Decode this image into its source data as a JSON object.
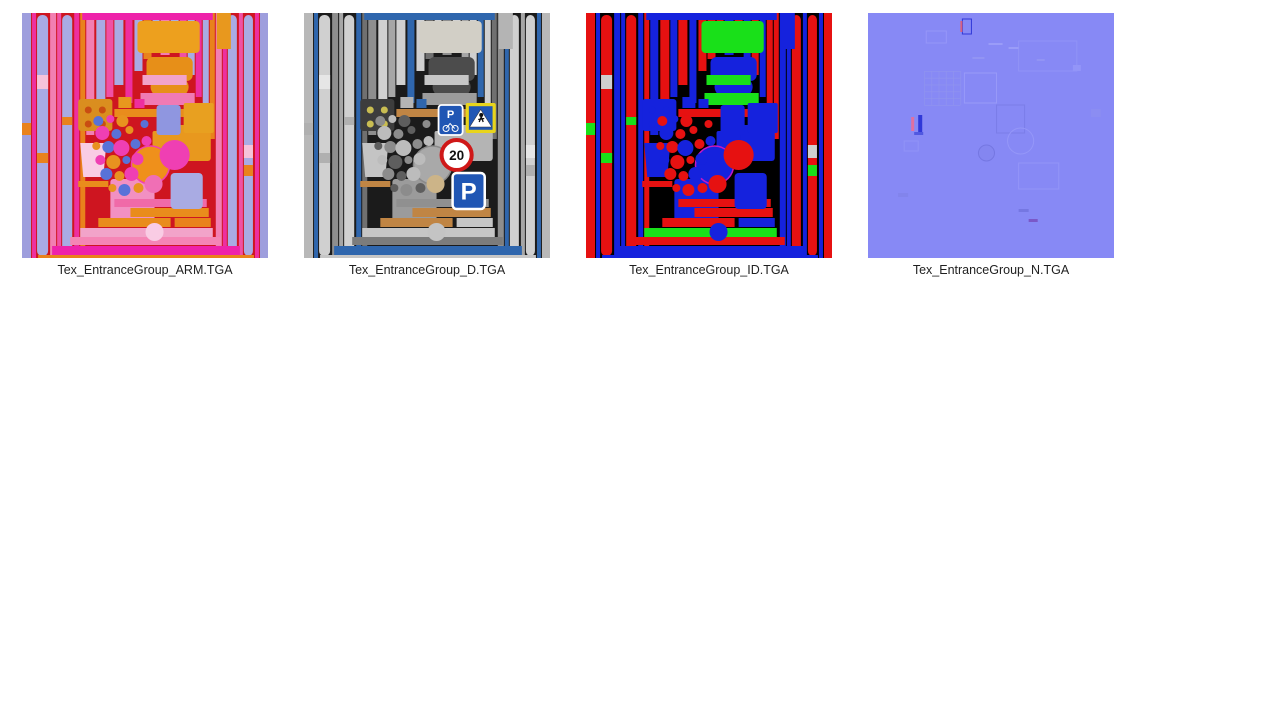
{
  "files": [
    {
      "label": "Tex_EntranceGroup_ARM.TGA",
      "map": "arm"
    },
    {
      "label": "Tex_EntranceGroup_D.TGA",
      "map": "d"
    },
    {
      "label": "Tex_EntranceGroup_ID.TGA",
      "map": "id"
    },
    {
      "label": "Tex_EntranceGroup_N.TGA",
      "map": "n"
    }
  ],
  "signs": {
    "parking_small": "P",
    "speed_limit": "20",
    "parking_large": "P"
  },
  "sign_colors": {
    "sign_blue": "#2056b4",
    "sign_yellow": "#e8d41c",
    "ring_red": "#cf1818",
    "sign_white": "#ffffff",
    "glyph_dark": "#111111"
  },
  "atlas": {
    "size": 245,
    "shapes": [
      [
        "r",
        0,
        0,
        9,
        245,
        "b1"
      ],
      [
        "r",
        10,
        0,
        4,
        245,
        "b2"
      ],
      [
        "r",
        15,
        2,
        11,
        241,
        "b3",
        5
      ],
      [
        "r",
        28,
        0,
        6,
        245,
        "b4"
      ],
      [
        "r",
        35,
        0,
        4,
        245,
        "b6"
      ],
      [
        "r",
        40,
        2,
        10,
        241,
        "b3",
        5
      ],
      [
        "r",
        52,
        0,
        5,
        245,
        "b2"
      ],
      [
        "r",
        58,
        0,
        5,
        245,
        "b5"
      ],
      [
        "r",
        64,
        0,
        8,
        122,
        "b4"
      ],
      [
        "r",
        74,
        0,
        9,
        100,
        "b3"
      ],
      [
        "r",
        84,
        0,
        7,
        84,
        "b6"
      ],
      [
        "r",
        92,
        0,
        9,
        72,
        "b3"
      ],
      [
        "r",
        103,
        0,
        7,
        90,
        "b2"
      ],
      [
        "r",
        112,
        0,
        8,
        58,
        "b3"
      ],
      [
        "r",
        121,
        0,
        8,
        46,
        "b5"
      ],
      [
        "r",
        130,
        0,
        7,
        40,
        "b3"
      ],
      [
        "r",
        138,
        0,
        9,
        42,
        "b4"
      ],
      [
        "r",
        148,
        0,
        8,
        38,
        "b3"
      ],
      [
        "r",
        157,
        0,
        7,
        52,
        "b6"
      ],
      [
        "r",
        165,
        0,
        7,
        62,
        "b3"
      ],
      [
        "r",
        173,
        0,
        6,
        84,
        "b2"
      ],
      [
        "r",
        180,
        0,
        6,
        104,
        "b3"
      ],
      [
        "r",
        187,
        0,
        5,
        126,
        "b5"
      ],
      [
        "r",
        193,
        0,
        6,
        245,
        "b4"
      ],
      [
        "r",
        200,
        0,
        4,
        245,
        "b2"
      ],
      [
        "r",
        205,
        2,
        9,
        241,
        "b3",
        5
      ],
      [
        "r",
        216,
        0,
        4,
        245,
        "b6"
      ],
      [
        "r",
        221,
        2,
        9,
        241,
        "b3",
        5
      ],
      [
        "r",
        232,
        0,
        4,
        245,
        "b2"
      ],
      [
        "r",
        237,
        0,
        8,
        245,
        "b1"
      ],
      [
        "r",
        15,
        62,
        11,
        14,
        "idw"
      ],
      [
        "r",
        15,
        140,
        11,
        10,
        "idg"
      ],
      [
        "r",
        40,
        104,
        10,
        8,
        "idg"
      ],
      [
        "r",
        221,
        132,
        9,
        13,
        "idw"
      ],
      [
        "r",
        221,
        152,
        9,
        11,
        "idg"
      ],
      [
        "r",
        0,
        110,
        9,
        12,
        "idg"
      ],
      [
        "r",
        194,
        0,
        14,
        36,
        "sq"
      ],
      [
        "r",
        60,
        0,
        130,
        7,
        "acc"
      ],
      [
        "r",
        115,
        8,
        62,
        32,
        "pane",
        4
      ],
      [
        "r",
        124,
        44,
        46,
        24,
        "pane2",
        6
      ],
      [
        "e",
        147,
        74,
        19,
        13,
        "pane2"
      ],
      [
        "r",
        120,
        62,
        44,
        10,
        "grn2"
      ],
      [
        "r",
        118,
        80,
        54,
        12,
        "grn"
      ],
      [
        "r",
        92,
        96,
        88,
        8,
        "met"
      ],
      [
        "r",
        56,
        86,
        34,
        32,
        "dark1",
        3
      ],
      [
        "c",
        66,
        97,
        3.5,
        "dot"
      ],
      [
        "c",
        80,
        97,
        3.5,
        "dot"
      ],
      [
        "c",
        66,
        111,
        3.5,
        "dot"
      ],
      [
        "c",
        80,
        111,
        3.5,
        "dot"
      ],
      [
        "r",
        96,
        84,
        13,
        11,
        "sq"
      ],
      [
        "r",
        112,
        86,
        10,
        9,
        "b2"
      ],
      [
        "p",
        "M58,130h26l-3,34h-20z",
        "box1"
      ],
      [
        "r",
        56,
        168,
        30,
        6,
        "met"
      ],
      [
        "r",
        88,
        166,
        44,
        48,
        "box2",
        3
      ],
      [
        "r",
        150,
        112,
        38,
        36,
        "sq",
        3
      ],
      [
        "r",
        130,
        118,
        24,
        24,
        "sq",
        2
      ],
      [
        "cs",
        128,
        152,
        19,
        "bigc",
        "bigcs",
        1.5
      ],
      [
        "c",
        76,
        108,
        5,
        "circA"
      ],
      [
        "c",
        88,
        106,
        4,
        "circB"
      ],
      [
        "c",
        100,
        108,
        6,
        "circC"
      ],
      [
        "c",
        80,
        120,
        7,
        "circB"
      ],
      [
        "c",
        94,
        121,
        5,
        "circA"
      ],
      [
        "c",
        107,
        117,
        4,
        "circC"
      ],
      [
        "c",
        74,
        133,
        4,
        "circC"
      ],
      [
        "c",
        86,
        134,
        6,
        "circA"
      ],
      [
        "c",
        99,
        135,
        8,
        "circB"
      ],
      [
        "c",
        113,
        131,
        5,
        "circA"
      ],
      [
        "c",
        78,
        147,
        5,
        "circB"
      ],
      [
        "c",
        91,
        149,
        7,
        "circC"
      ],
      [
        "c",
        104,
        147,
        4,
        "circA"
      ],
      [
        "c",
        115,
        146,
        6,
        "circB"
      ],
      [
        "c",
        84,
        161,
        6,
        "circA"
      ],
      [
        "c",
        97,
        163,
        5,
        "circC"
      ],
      [
        "c",
        109,
        161,
        7,
        "circB"
      ],
      [
        "c",
        90,
        175,
        4,
        "circC"
      ],
      [
        "c",
        102,
        177,
        6,
        "circA"
      ],
      [
        "c",
        116,
        175,
        5,
        "circC"
      ],
      [
        "c",
        124,
        128,
        5,
        "circB"
      ],
      [
        "c",
        122,
        111,
        4,
        "circA"
      ],
      [
        "c",
        131,
        171,
        9,
        "bigc2"
      ],
      [
        "r",
        92,
        186,
        92,
        8,
        "hb1"
      ],
      [
        "r",
        108,
        195,
        78,
        9,
        "met"
      ],
      [
        "r",
        76,
        205,
        72,
        9,
        "met"
      ],
      [
        "r",
        152,
        205,
        36,
        9,
        "hb2"
      ],
      [
        "r",
        58,
        215,
        132,
        9,
        "grn2"
      ],
      [
        "r",
        48,
        224,
        150,
        8,
        "hb3"
      ],
      [
        "c",
        132,
        219,
        9,
        "box1"
      ],
      [
        "r",
        30,
        233,
        187,
        9,
        "acc"
      ],
      [
        "r",
        16,
        242,
        215,
        3,
        "hb2"
      ],
      [
        "sign-pbike",
        134,
        92,
        24,
        30
      ],
      [
        "sign-cross",
        161,
        90,
        30,
        30
      ],
      [
        "sign-20",
        152,
        142,
        15
      ],
      [
        "sign-pbig",
        148,
        160,
        32,
        36
      ]
    ],
    "palettes": {
      "arm": {
        "bg": "#ce1520",
        "b1": "#9e9edd",
        "b2": "#ee2f9f",
        "b3": "#a9abe3",
        "b4": "#f27fb2",
        "b5": "#e9821c",
        "b6": "#f051a4",
        "idg": "#e9821c",
        "idw": "#f6c3da",
        "met": "#e98c1c",
        "pane": "#eda01e",
        "pane2": "#e78f18",
        "grn": "#f07ab4",
        "grn2": "#f2a3c9",
        "dark1": "#da8e1f",
        "dot": "#c94d12",
        "sq": "#e8981e",
        "box1": "#f9cce4",
        "box2": "#f290c2",
        "bigc": "#ef901b",
        "bigcs": "#f23fb0",
        "bigc2": "#f06fb5",
        "circA": "#5872d8",
        "circB": "#ef3fb3",
        "circC": "#e8921f",
        "hb1": "#f06aa8",
        "hb2": "#e9821c",
        "hb3": "#f585b5",
        "acc": "#ee22aa",
        "sgn1": "#8f96e0",
        "sgn2": "#e8a020",
        "s20f": "#ef3fb3",
        "sgnP": "#a9abe3"
      },
      "d": {
        "bg": "#1b1b1b",
        "b1": "#b8b8b8",
        "b2": "#2f66ad",
        "b3": "#d0d0d0",
        "b4": "#8e8e8e",
        "b5": "#707070",
        "b6": "#a6a6a6",
        "idg": "#b0b0b0",
        "idw": "#e6e6e6",
        "met": "#c08544",
        "pane": "#d2cfc6",
        "pane2": "#4c4c4c",
        "grn": "#9c9c9c",
        "grn2": "#c6c6c6",
        "dark1": "#3d3d3d",
        "dot": "#c9bd52",
        "sq": "#b4b4b4",
        "box1": "#c4c4c4",
        "box2": "#9b9b9b",
        "bigc": "#a9a9a9",
        "bigcs": "#8a8a8a",
        "bigc2": "#ccb488",
        "circA": "#8c8c8c",
        "circB": "#bcbcbc",
        "circC": "#5e5e5e",
        "hb1": "#909090",
        "hb2": "#c6c6c6",
        "hb3": "#7c7c7c",
        "acc": "#2f66ad",
        "sgn1": "#2056b4",
        "sgn2": "#e8d41c",
        "s20f": "#ffffff",
        "sgnP": "#2056b4"
      },
      "id": {
        "bg": "#000000",
        "b1": "#e61111",
        "b2": "#1522dd",
        "b3": "#e61111",
        "b4": "#1522dd",
        "b5": "#e61111",
        "b6": "#1522dd",
        "idg": "#19e019",
        "idw": "#cfcfcf",
        "met": "#e61111",
        "pane": "#19e019",
        "pane2": "#1522dd",
        "grn": "#19e019",
        "grn2": "#19e019",
        "dark1": "#1522dd",
        "dot": "#1522dd",
        "sq": "#1522dd",
        "box1": "#1522dd",
        "box2": "#1522dd",
        "bigc": "#1522dd",
        "bigcs": "#c517c5",
        "bigc2": "#e61111",
        "circA": "#e61111",
        "circB": "#1522dd",
        "circC": "#e61111",
        "hb1": "#e61111",
        "hb2": "#1522dd",
        "hb3": "#e61111",
        "acc": "#1522dd",
        "sgn1": "#1522dd",
        "sgn2": "#1522dd",
        "s20f": "#e61111",
        "sgnP": "#1522dd"
      }
    }
  },
  "normal_map": {
    "bg": "#8789f5",
    "shapes": [
      [
        "sr",
        96,
        60,
        32,
        30,
        "#989af8"
      ],
      [
        "sr",
        128,
        92,
        28,
        28,
        "#7b7de8"
      ],
      [
        "sr",
        150,
        28,
        58,
        30,
        "#9193f6"
      ],
      [
        "sr",
        58,
        18,
        20,
        12,
        "#9696f8"
      ],
      [
        "grid",
        56,
        58,
        36,
        34,
        5,
        "#9093ef"
      ],
      [
        "sr",
        150,
        150,
        40,
        26,
        "#9395f8"
      ],
      [
        "r",
        204,
        52,
        8,
        6,
        "#9395f8"
      ],
      [
        "r",
        30,
        180,
        10,
        4,
        "#8284ec"
      ],
      [
        "r",
        150,
        196,
        10,
        3,
        "#7577e2"
      ],
      [
        "r",
        50,
        102,
        4,
        18,
        "#3038d8"
      ],
      [
        "r",
        43,
        104,
        3,
        14,
        "#e070a0"
      ],
      [
        "r",
        46,
        119,
        9,
        3,
        "#5058e0"
      ],
      [
        "sr",
        94,
        6,
        9,
        15,
        "#3038d8"
      ],
      [
        "r",
        92,
        8,
        2,
        11,
        "#d86080"
      ],
      [
        "sc",
        152,
        128,
        13,
        "#9597f8"
      ],
      [
        "fc",
        118,
        140,
        8,
        "#8486f0",
        "#7577e2"
      ],
      [
        "r",
        160,
        206,
        9,
        3,
        "#7a58c8"
      ],
      [
        "sr",
        36,
        128,
        14,
        10,
        "#9193f6"
      ],
      [
        "r",
        222,
        96,
        10,
        8,
        "#8b8df2"
      ],
      [
        "r",
        120,
        30,
        14,
        2,
        "#9a9cf8"
      ],
      [
        "r",
        140,
        34,
        10,
        2,
        "#9a9cf8"
      ],
      [
        "r",
        104,
        44,
        12,
        2,
        "#9294f4"
      ],
      [
        "r",
        168,
        46,
        8,
        2,
        "#9294f4"
      ]
    ]
  }
}
